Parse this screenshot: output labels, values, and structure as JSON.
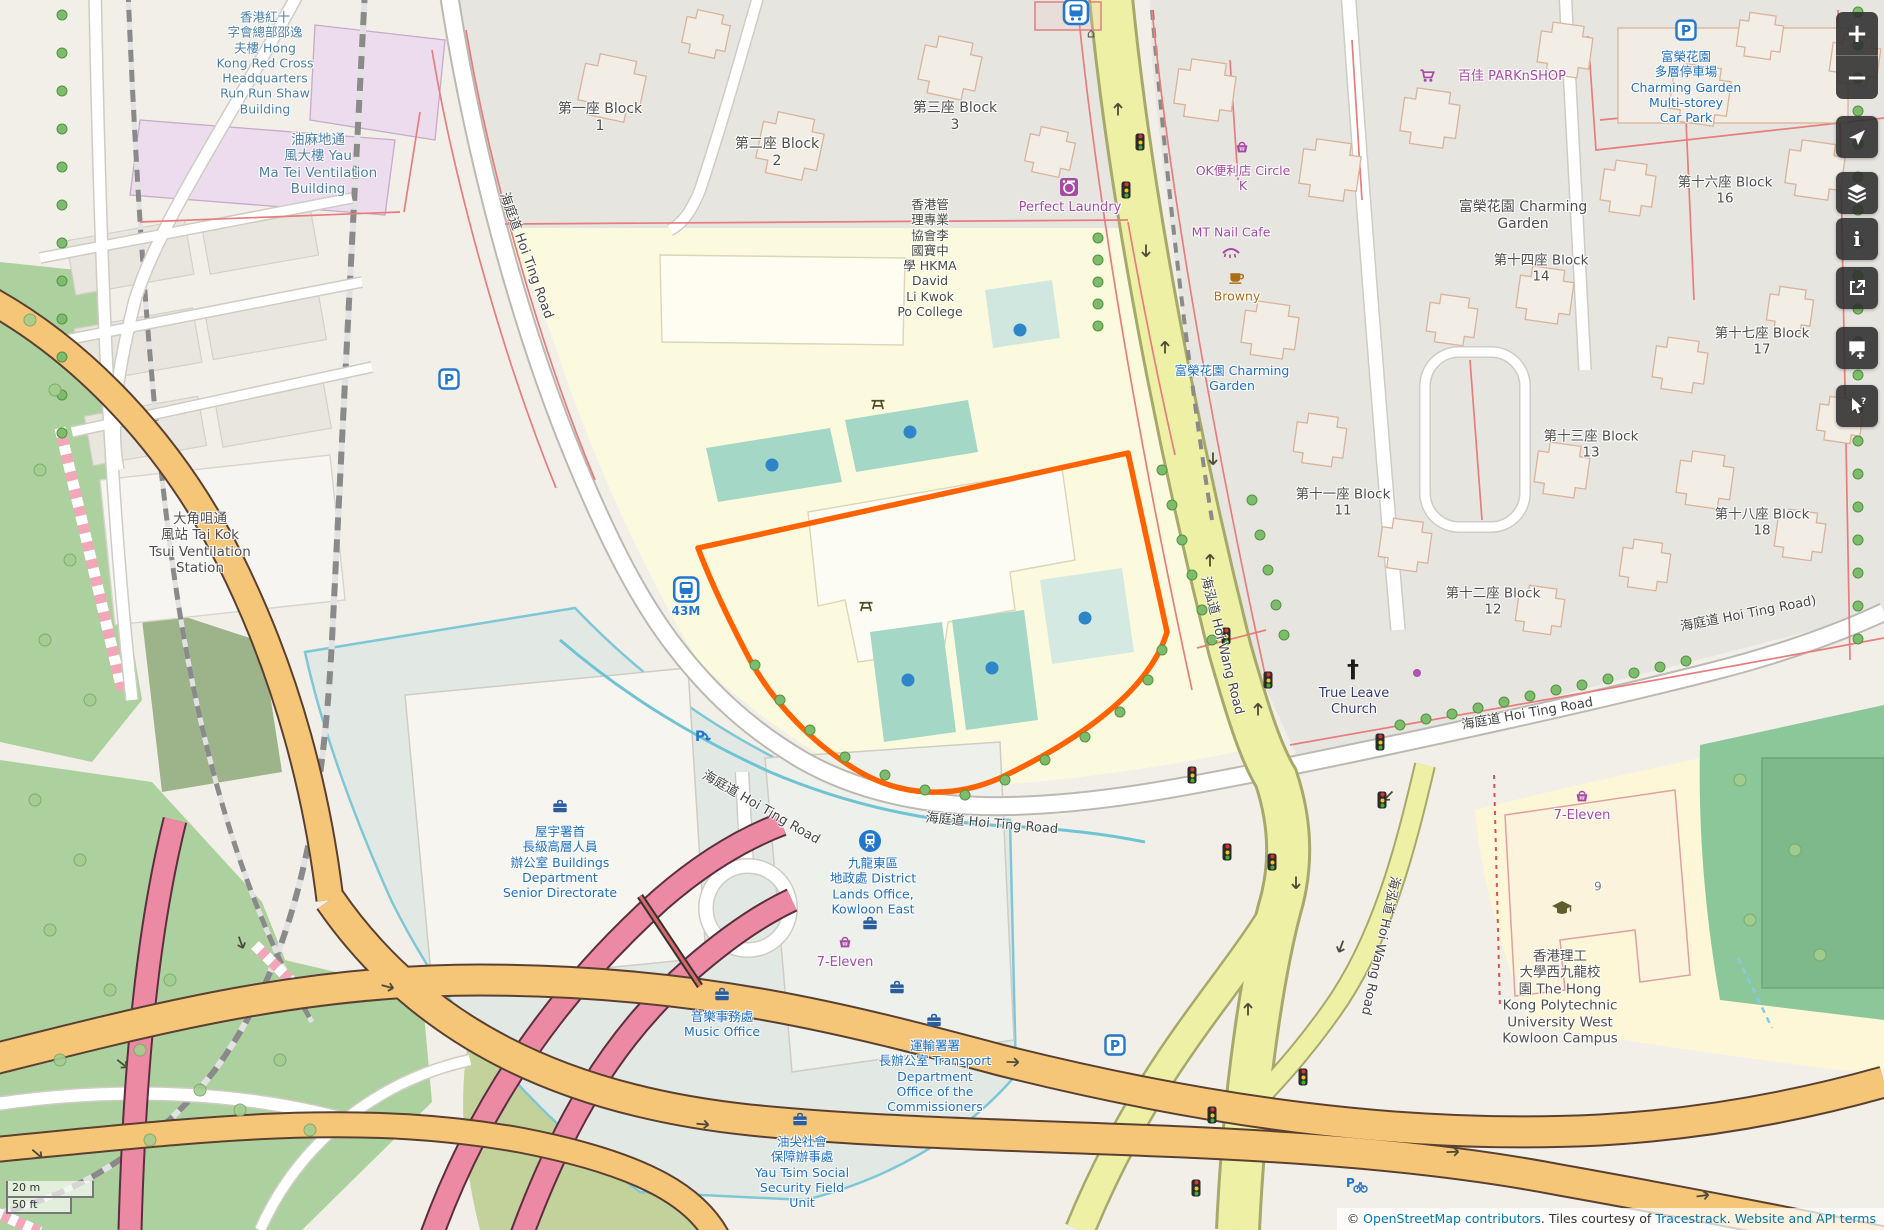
{
  "palette": {
    "poi_purple": "#a649a3",
    "amenity_blue": "#1e6fc0",
    "building_blue": "#4c7fa6",
    "label_gray": "#4e4e4e",
    "brown": "#ad6d15",
    "church_dark": "#34386b",
    "house_gray": "#7a7a7a",
    "school_gray": "#4b4b45",
    "selection_orange": "#ff6200",
    "road_yellow": "#eef0a5",
    "icon_blue": "#2277cc",
    "dark_olive": "#4f4f23"
  },
  "scale_bar": {
    "metric": "20 m",
    "imperial": "50 ft"
  },
  "attribution": {
    "prefix": "© ",
    "link_osm": "OpenStreetMap contributors",
    "middle": ". Tiles courtesy of ",
    "link_tiles": "Tracestrack",
    "separator": ". ",
    "link_terms": "Website and API terms"
  },
  "controls": [
    {
      "id": "zoom-in",
      "glyph": "+"
    },
    {
      "id": "zoom-out",
      "glyph": "−"
    },
    {
      "id": "locate"
    },
    {
      "id": "layers"
    },
    {
      "id": "info",
      "glyph": "i"
    },
    {
      "id": "share"
    },
    {
      "id": "add-note"
    },
    {
      "id": "query-features",
      "glyph": "?"
    }
  ],
  "map": {
    "place_labels": [
      {
        "id": "red-cross",
        "lines": [
          "香港紅十",
          "字會總部邵逸",
          "夫樓 Hong",
          "Kong Red Cross",
          "Headquarters",
          "Run Run Shaw",
          "Building"
        ],
        "x": 265,
        "y": 63,
        "color": "building_blue",
        "size": 12.5
      },
      {
        "id": "yau-ma-tei-vent",
        "lines": [
          "油麻地通",
          "風大樓 Yau",
          "Ma Tei Ventilation",
          "Building"
        ],
        "x": 318,
        "y": 165,
        "color": "building_blue",
        "size": 13.5
      },
      {
        "id": "block-1",
        "lines": [
          "第一座 Block",
          "1"
        ],
        "x": 600,
        "y": 118,
        "color": "label_gray",
        "size": 14
      },
      {
        "id": "block-2",
        "lines": [
          "第二座 Block",
          "2"
        ],
        "x": 777,
        "y": 153,
        "color": "label_gray",
        "size": 14
      },
      {
        "id": "block-3",
        "lines": [
          "第三座 Block",
          "3"
        ],
        "x": 955,
        "y": 117,
        "color": "label_gray",
        "size": 14
      },
      {
        "id": "hkma-college",
        "lines": [
          "香港管",
          "理專業",
          "協會李",
          "國寶中",
          "學 HKMA",
          "David",
          "Li Kwok",
          "Po College"
        ],
        "x": 930,
        "y": 258,
        "color": "school_gray",
        "size": 12.5
      },
      {
        "id": "perfect-laundry",
        "lines": [
          "Perfect Laundry"
        ],
        "x": 1070,
        "y": 208,
        "color": "poi_purple",
        "size": 13
      },
      {
        "id": "circle-k",
        "lines": [
          "OK便利店 Circle",
          "K"
        ],
        "x": 1243,
        "y": 178,
        "color": "poi_purple",
        "size": 12.5
      },
      {
        "id": "mt-nail-cafe",
        "lines": [
          "MT Nail Cafe"
        ],
        "x": 1231,
        "y": 232,
        "color": "poi_purple",
        "size": 12.5
      },
      {
        "id": "browny",
        "lines": [
          "Browny"
        ],
        "x": 1237,
        "y": 296,
        "color": "brown",
        "size": 12.5
      },
      {
        "id": "parknshop",
        "lines": [
          "百佳 PARKnSHOP"
        ],
        "x": 1512,
        "y": 77,
        "color": "poi_purple",
        "size": 13
      },
      {
        "id": "cg-car-park",
        "lines": [
          "富榮花園",
          "多層停車場",
          "Charming Garden",
          "Multi-storey",
          "Car Park"
        ],
        "x": 1686,
        "y": 87,
        "color": "amenity_blue",
        "size": 12.5
      },
      {
        "id": "block-16",
        "lines": [
          "第十六座 Block",
          "16"
        ],
        "x": 1725,
        "y": 191,
        "color": "label_gray",
        "size": 13.5
      },
      {
        "id": "charming-garden",
        "lines": [
          "富榮花園 Charming",
          "Garden"
        ],
        "x": 1523,
        "y": 216,
        "color": "label_gray",
        "size": 14
      },
      {
        "id": "block-14",
        "lines": [
          "第十四座 Block",
          "14"
        ],
        "x": 1541,
        "y": 269,
        "color": "label_gray",
        "size": 13.5
      },
      {
        "id": "block-17",
        "lines": [
          "第十七座 Block",
          "17"
        ],
        "x": 1762,
        "y": 342,
        "color": "label_gray",
        "size": 13.5
      },
      {
        "id": "block-13",
        "lines": [
          "第十三座 Block",
          "13"
        ],
        "x": 1591,
        "y": 445,
        "color": "label_gray",
        "size": 13.5
      },
      {
        "id": "block-11",
        "lines": [
          "第十一座 Block",
          "11"
        ],
        "x": 1343,
        "y": 503,
        "color": "label_gray",
        "size": 13.5
      },
      {
        "id": "block-18",
        "lines": [
          "第十八座 Block",
          "18"
        ],
        "x": 1762,
        "y": 523,
        "color": "label_gray",
        "size": 13.5
      },
      {
        "id": "block-12",
        "lines": [
          "第十二座 Block",
          "12"
        ],
        "x": 1493,
        "y": 602,
        "color": "label_gray",
        "size": 13.5
      },
      {
        "id": "cg-transit",
        "lines": [
          "富榮花園 Charming",
          "Garden"
        ],
        "x": 1232,
        "y": 378,
        "color": "amenity_blue",
        "size": 12.5
      },
      {
        "id": "true-leave-church",
        "lines": [
          "True Leave",
          "Church"
        ],
        "x": 1354,
        "y": 702,
        "color": "church_dark",
        "size": 13
      },
      {
        "id": "tai-kok-tsui-vent",
        "lines": [
          "大角咀通",
          "風站 Tai Kok",
          "Tsui Ventilation",
          "Station"
        ],
        "x": 200,
        "y": 544,
        "color": "label_gray",
        "size": 13.5
      },
      {
        "id": "buildings-dept",
        "lines": [
          "屋宇署首",
          "長級高層人員",
          "辦公室 Buildings",
          "Department",
          "Senior Directorate"
        ],
        "x": 560,
        "y": 862,
        "color": "amenity_blue",
        "size": 12.5
      },
      {
        "id": "district-lands",
        "lines": [
          "九龍東區",
          "地政處 District",
          "Lands Office,",
          "Kowloon East"
        ],
        "x": 873,
        "y": 886,
        "color": "amenity_blue",
        "size": 12.5
      },
      {
        "id": "seven-eleven-1",
        "lines": [
          "7-Eleven"
        ],
        "x": 845,
        "y": 963,
        "color": "poi_purple",
        "size": 13
      },
      {
        "id": "music-office",
        "lines": [
          "音樂事務處",
          "Music Office"
        ],
        "x": 722,
        "y": 1024,
        "color": "amenity_blue",
        "size": 12.5
      },
      {
        "id": "transport-dept",
        "lines": [
          "運輸署署",
          "長辦公室 Transport",
          "Department",
          "Office of the",
          "Commissioners"
        ],
        "x": 935,
        "y": 1076,
        "color": "amenity_blue",
        "size": 12.5
      },
      {
        "id": "yau-tsim-ssfu",
        "lines": [
          "油尖社會",
          "保障辦事處",
          "Yau Tsim Social",
          "Security Field",
          "Unit"
        ],
        "x": 802,
        "y": 1172,
        "color": "amenity_blue",
        "size": 12.5
      },
      {
        "id": "polyu-campus",
        "lines": [
          "香港理工",
          "大學西九龍校",
          "園 The Hong",
          "Kong Polytechnic",
          "University West",
          "Kowloon Campus"
        ],
        "x": 1560,
        "y": 998,
        "color": "label_gray",
        "size": 13.5
      },
      {
        "id": "seven-eleven-2",
        "lines": [
          "7-Eleven"
        ],
        "x": 1582,
        "y": 816,
        "color": "poi_purple",
        "size": 13
      },
      {
        "id": "house-number-9",
        "lines": [
          "9"
        ],
        "x": 1598,
        "y": 887,
        "color": "house_gray",
        "size": 12
      }
    ],
    "road_labels": [
      {
        "id": "hoi-ting-w",
        "text": "海庭道 Hoi Ting Road",
        "x": 528,
        "y": 255,
        "rot": 70
      },
      {
        "id": "hoi-ting-bend",
        "text": "海庭道 Hoi Ting Road",
        "x": 762,
        "y": 806,
        "rot": 30
      },
      {
        "id": "hoi-ting-mid",
        "text": "海庭道 Hoi Ting Road",
        "x": 992,
        "y": 822,
        "rot": 5
      },
      {
        "id": "hoi-ting-e1",
        "text": "海庭道 Hoi Ting Road",
        "x": 1527,
        "y": 712,
        "rot": -10
      },
      {
        "id": "hoi-ting-e2",
        "text": "海庭道 Hoi Ting Road)",
        "x": 1748,
        "y": 612,
        "rot": -11
      },
      {
        "id": "hoi-wang-n",
        "text": "海泓道 Hoi Wang Road",
        "x": 1224,
        "y": 645,
        "rot": 76
      },
      {
        "id": "hoi-wang-s",
        "text": "海泓道 Hoi Wang Road",
        "x": 1382,
        "y": 946,
        "rot": 102
      }
    ],
    "pois": [
      {
        "id": "perfect-laundry-icon",
        "icon": "laundry",
        "x": 1069,
        "y": 187,
        "color": "#a649a3"
      },
      {
        "id": "circle-k-icon",
        "icon": "basket",
        "x": 1242,
        "y": 147,
        "color": "#a649a3"
      },
      {
        "id": "mt-nail-icon",
        "icon": "eyelash",
        "x": 1231,
        "y": 252,
        "color": "#a649a3"
      },
      {
        "id": "browny-icon",
        "icon": "coffee",
        "x": 1237,
        "y": 277,
        "color": "#ad6d15"
      },
      {
        "id": "parknshop-icon",
        "icon": "cart",
        "x": 1428,
        "y": 76,
        "color": "#a649a3"
      },
      {
        "id": "car-park-icon",
        "icon": "parking",
        "x": 1686,
        "y": 30
      },
      {
        "id": "seven-eleven-1-icon",
        "icon": "basket",
        "x": 845,
        "y": 942,
        "color": "#a649a3"
      },
      {
        "id": "seven-eleven-2-icon",
        "icon": "basket",
        "x": 1582,
        "y": 796,
        "color": "#a649a3"
      },
      {
        "id": "polyu-icon",
        "icon": "gradcap",
        "x": 1562,
        "y": 908,
        "color": "#5e5e2e"
      },
      {
        "id": "church-cross-icon",
        "icon": "church",
        "x": 1353,
        "y": 669,
        "color": "#1c1c1c"
      },
      {
        "id": "station-icon",
        "icon": "train",
        "x": 870,
        "y": 841
      },
      {
        "id": "bus-stop-top-icon",
        "icon": "bus",
        "x": 1076,
        "y": 12
      },
      {
        "id": "bus-stop-43m-icon",
        "icon": "bus",
        "x": 686,
        "y": 597,
        "label": "43M"
      },
      {
        "id": "parking-left-icon",
        "icon": "parking",
        "x": 449,
        "y": 379
      },
      {
        "id": "parking-entrance-icon",
        "icon": "parking-entrance",
        "x": 702,
        "y": 737
      },
      {
        "id": "parking-hwy-icon",
        "icon": "parking",
        "x": 1115,
        "y": 1045
      },
      {
        "id": "bicycle-parking-icon",
        "icon": "bike-parking",
        "x": 1356,
        "y": 1184
      },
      {
        "id": "picnic-icon-1",
        "icon": "picnic",
        "x": 878,
        "y": 404,
        "color": "#4f4f23"
      },
      {
        "id": "picnic-icon-2",
        "icon": "picnic",
        "x": 866,
        "y": 606,
        "color": "#4f4f23"
      },
      {
        "id": "briefcase-buildings-dept",
        "icon": "briefcase",
        "x": 560,
        "y": 806,
        "color": "#2b5d9e"
      },
      {
        "id": "briefcase-music",
        "icon": "briefcase",
        "x": 722,
        "y": 994,
        "color": "#2b5d9e"
      },
      {
        "id": "briefcase-transport",
        "icon": "briefcase",
        "x": 934,
        "y": 1020,
        "color": "#2b5d9e"
      },
      {
        "id": "briefcase-yau-tsim",
        "icon": "briefcase",
        "x": 800,
        "y": 1119,
        "color": "#2b5d9e"
      },
      {
        "id": "briefcase-office-1",
        "icon": "briefcase",
        "x": 870,
        "y": 923,
        "color": "#2b5d9e"
      },
      {
        "id": "briefcase-office-2",
        "icon": "briefcase",
        "x": 897,
        "y": 987,
        "color": "#2b5d9e"
      },
      {
        "id": "house-icon",
        "icon": "house",
        "x": 1091,
        "y": 34,
        "color": "#555555"
      }
    ],
    "traffic_lights": [
      [
        1140,
        142
      ],
      [
        1126,
        190
      ],
      [
        1226,
        636
      ],
      [
        1268,
        680
      ],
      [
        1380,
        742
      ],
      [
        1192,
        775
      ],
      [
        1227,
        852
      ],
      [
        1382,
        800
      ],
      [
        1272,
        862
      ],
      [
        1303,
        1077
      ],
      [
        1212,
        1115
      ],
      [
        1196,
        1188
      ]
    ],
    "blue_dots": [
      [
        772,
        465
      ],
      [
        910,
        432
      ],
      [
        1020,
        330
      ],
      [
        908,
        680
      ],
      [
        992,
        668
      ],
      [
        1085,
        618
      ]
    ],
    "purple_dots": [
      [
        1417,
        673
      ]
    ]
  }
}
